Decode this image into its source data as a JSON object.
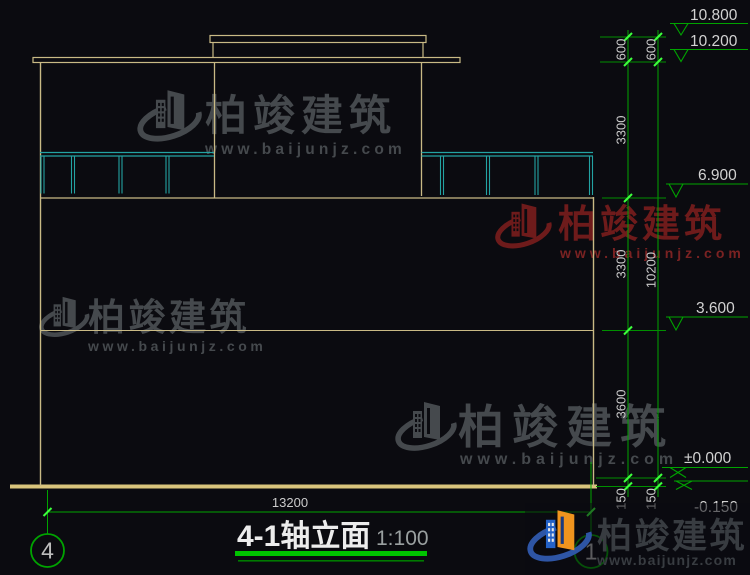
{
  "drawing": {
    "title": "4-1轴立面",
    "scale": "1:100",
    "axis_left": "4",
    "axis_right": "1",
    "bottom_dim": "13200",
    "dims_inner": [
      "600",
      "3300",
      "3300",
      "3600",
      "150"
    ],
    "dims_outer": [
      "600",
      "10200",
      "150"
    ],
    "levels": [
      "10.800",
      "10.200",
      "6.900",
      "3.600",
      "±0.000",
      "-0.150"
    ]
  },
  "watermark": {
    "brand": "柏竣建筑",
    "url": "www.baijunjz.com"
  },
  "colors": {
    "background": "#0b0b10",
    "building_line": "#c9ba85",
    "railing_line": "#23a3a3",
    "dimension_green": "#00a400",
    "text_gray": "#cbcbcb",
    "watermark_gray": "#45494d",
    "watermark_red": "#6e1b1b",
    "logo_blue": "#2e55a5",
    "logo_orange": "#f0941e",
    "title_underline": "#00c400"
  }
}
